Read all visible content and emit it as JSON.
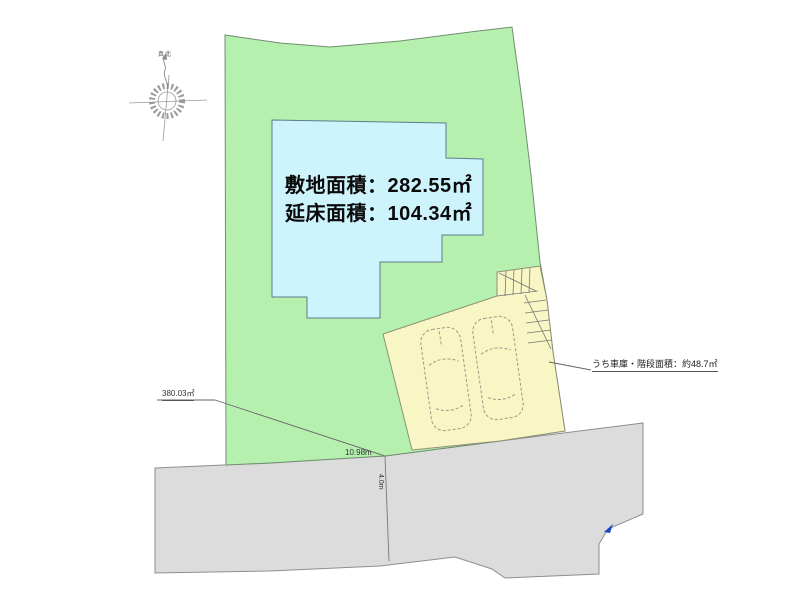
{
  "drawing": {
    "type": "site-plan",
    "labels": {
      "site_area": "敷地面積：282.55㎡",
      "floor_area": "延床面積：104.34㎡",
      "garage_note": "うち車庫・階段面積：約48.7㎡",
      "boundary_area": "380.03㎡",
      "frontage": "10.98m",
      "road_width": "4.0m",
      "north": "真北"
    },
    "colors": {
      "land": "#b6f0ae",
      "building": "#cdf3fc",
      "parking": "#f8f6c5",
      "road": "#dcdcdc",
      "outline": "#7f8f7f",
      "line": "#777777",
      "car_line": "#9a9a88",
      "marker_blue": "#1848c0",
      "text": "#0a0a0a"
    }
  }
}
